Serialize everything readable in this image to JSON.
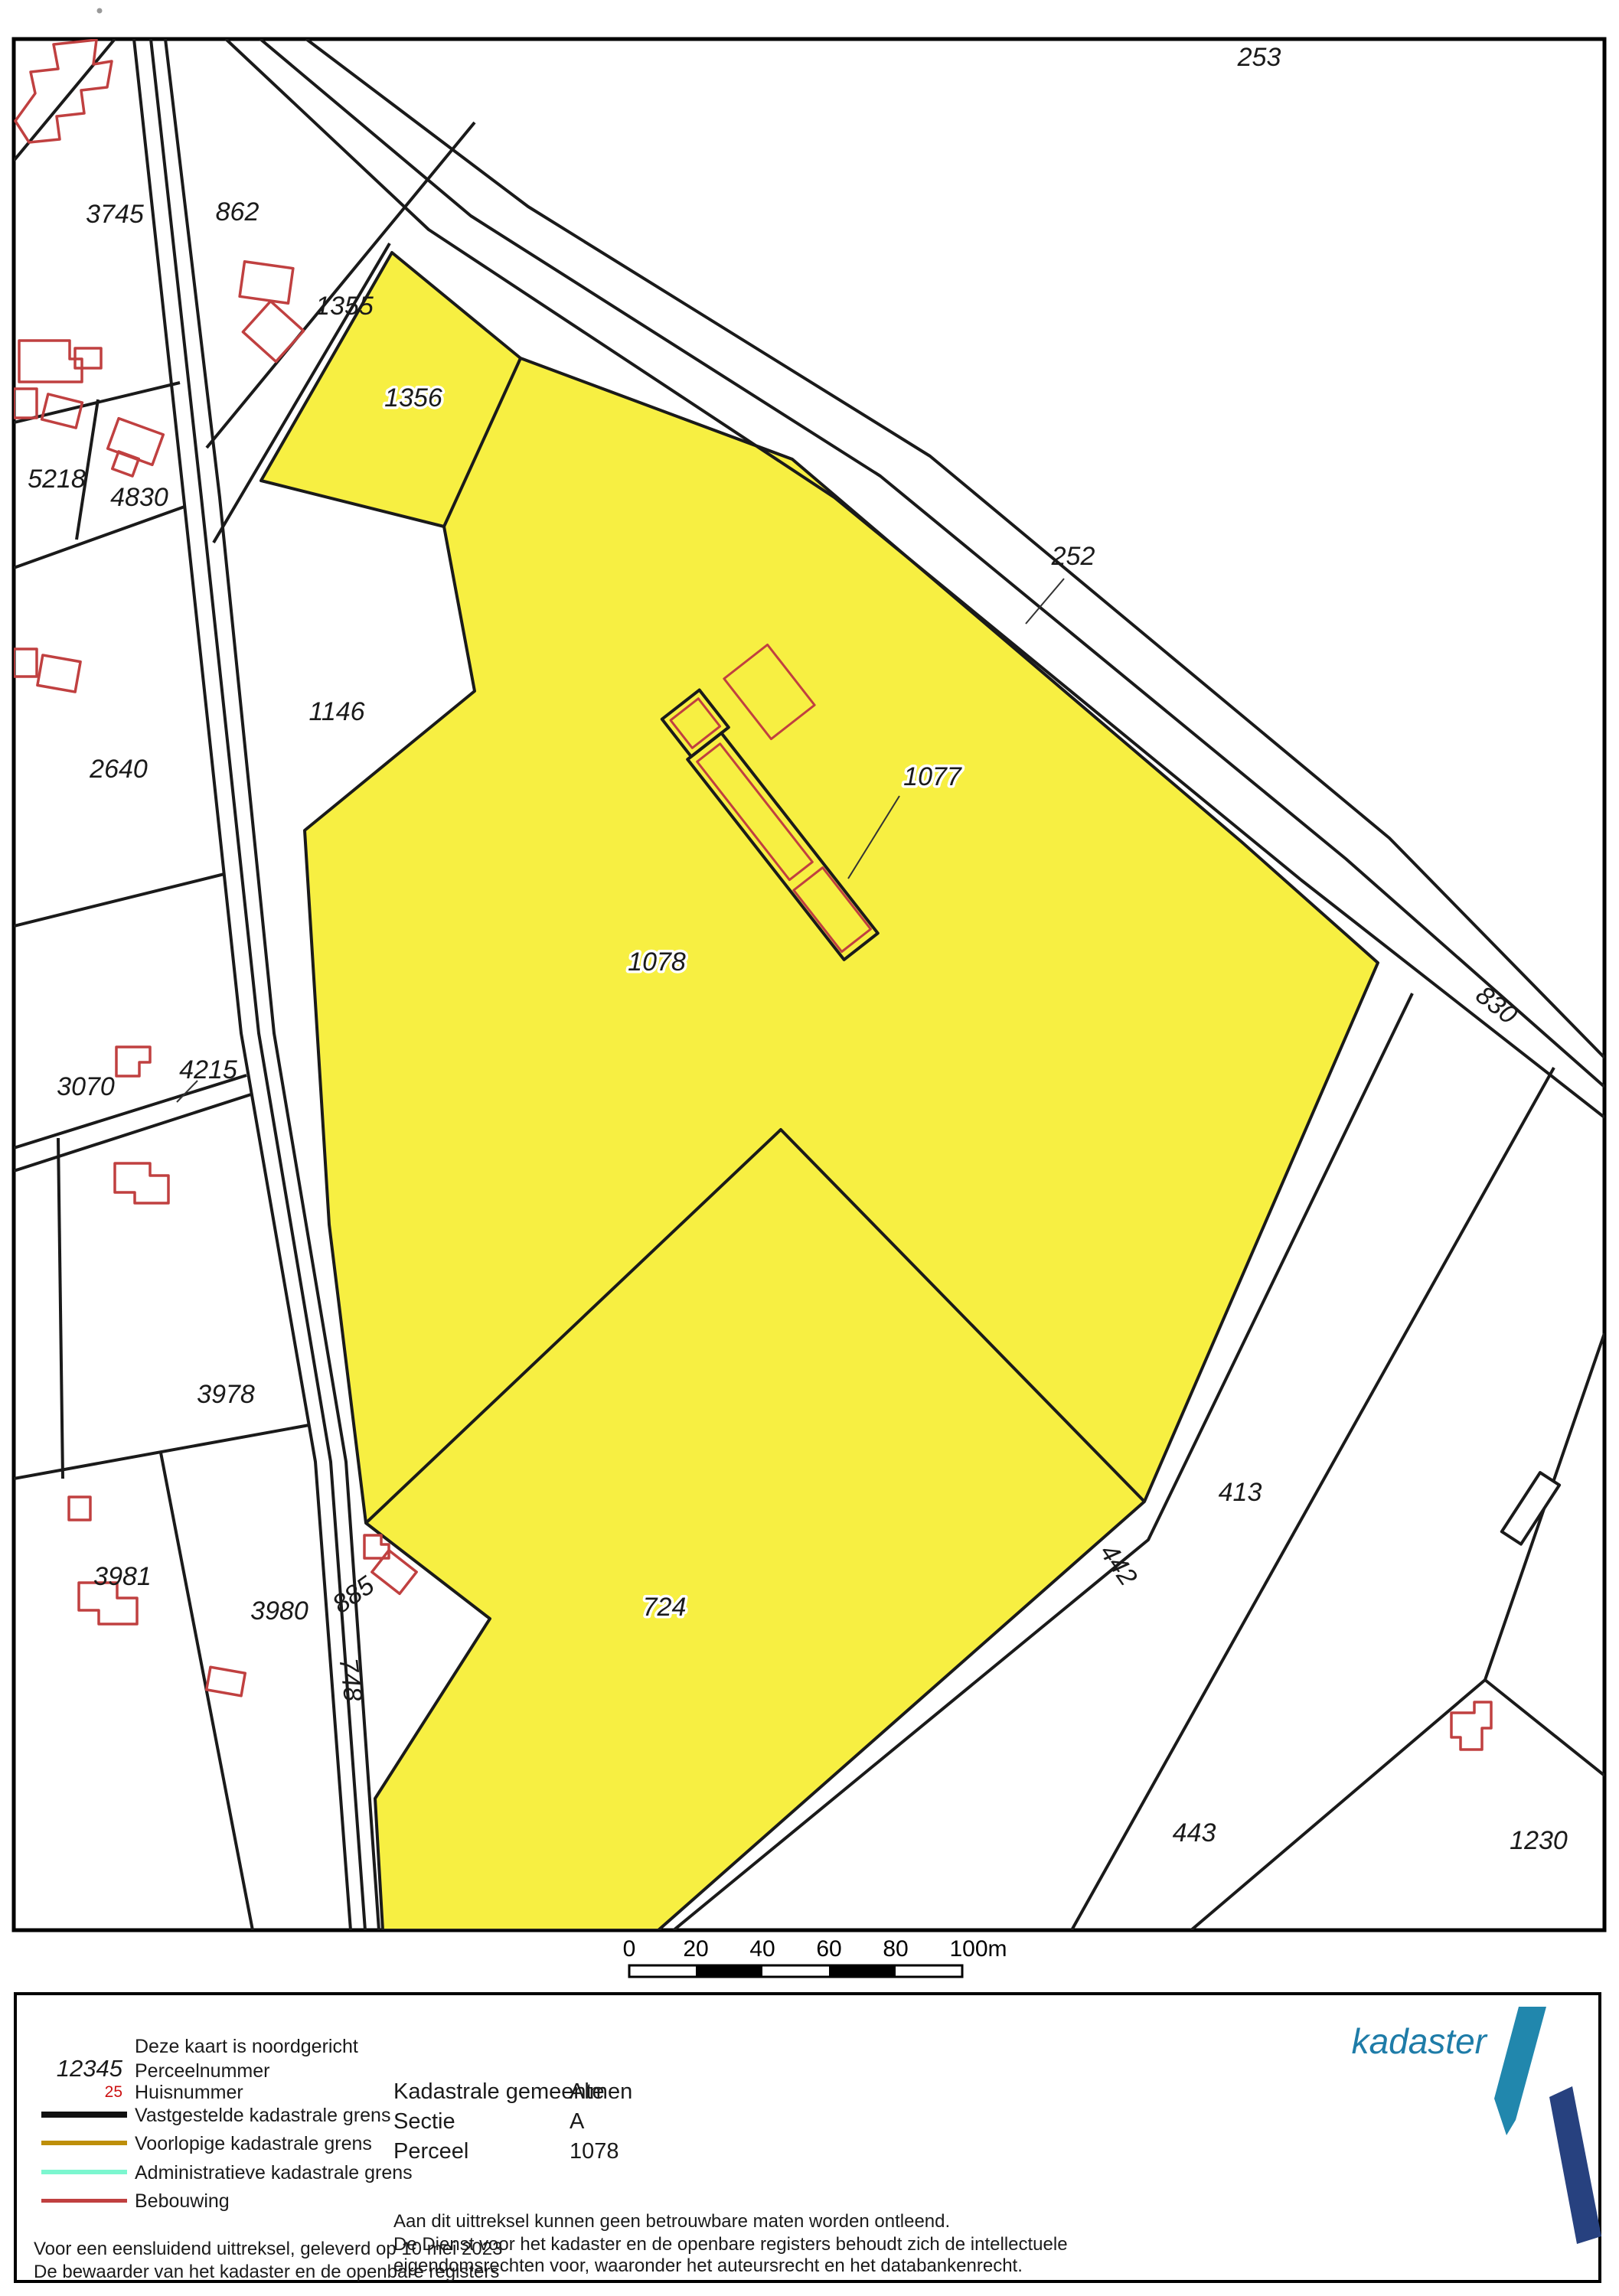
{
  "map": {
    "labels": {
      "p253": "253",
      "p3745": "3745",
      "p862": "862",
      "p1355": "1355",
      "p1356": "1356",
      "p5218": "5218",
      "p4830": "4830",
      "p1146": "1146",
      "p2640": "2640",
      "p252": "252",
      "p1077": "1077",
      "p1078": "1078",
      "p830": "830",
      "p3070": "3070",
      "p4215": "4215",
      "p3978": "3978",
      "p3981": "3981",
      "p3980": "3980",
      "p885": "885",
      "p748": "748",
      "p724": "724",
      "p442": "442",
      "p413": "413",
      "p443": "443",
      "p1230": "1230"
    },
    "highlighted_parcels": [
      "1356",
      "1077",
      "1078",
      "724"
    ],
    "scale": {
      "t0": "0",
      "t20": "20",
      "t40": "40",
      "t60": "60",
      "t80": "80",
      "t100": "100m"
    }
  },
  "legend": {
    "north_note": "Deze kaart is noordgericht",
    "perceelnummer_sample": "12345",
    "perceelnummer_label": "Perceelnummer",
    "huisnummer_sample": "25",
    "huisnummer_label": "Huisnummer",
    "items": [
      {
        "label": "Vastgestelde kadastrale grens",
        "color": "#111111",
        "thick": "8px"
      },
      {
        "label": "Voorlopige kadastrale grens",
        "color": "#BE8F0A",
        "thick": "6px"
      },
      {
        "label": "Administratieve kadastrale grens",
        "color": "#7CF6CF",
        "thick": "6px"
      },
      {
        "label": "Bebouwing",
        "color": "#C04040",
        "thick": "5px"
      }
    ],
    "delivery_line1": "Voor een eensluidend uittreksel, geleverd op 10 mei 2023",
    "delivery_line2": "De bewaarder van het kadaster en de openbare registers"
  },
  "info": {
    "gemeente_label": "Kadastrale gemeente",
    "gemeente_value": "Almen",
    "sectie_label": "Sectie",
    "sectie_value": "A",
    "perceel_label": "Perceel",
    "perceel_value": "1078"
  },
  "disclaimer": {
    "line1": "Aan dit uittreksel kunnen geen betrouwbare maten worden ontleend.",
    "line2": "De Dienst voor het kadaster en de openbare registers behoudt zich de intellectuele",
    "line3": "eigendomsrechten voor, waaronder het auteursrecht en het databankenrecht."
  },
  "logo": {
    "text": "kadaster"
  },
  "colors": {
    "highlight_yellow": "#F7EF42",
    "boundary_black": "#1a1a1a",
    "building_red": "#C04040",
    "huisnummer_red": "#CC1111",
    "voorlopige_amber": "#BE8F0A",
    "administratieve_aqua": "#7CF6CF",
    "logo_teal": "#2187AD",
    "logo_text_blue": "#1E7CA8",
    "logo_navy": "#27417F"
  }
}
